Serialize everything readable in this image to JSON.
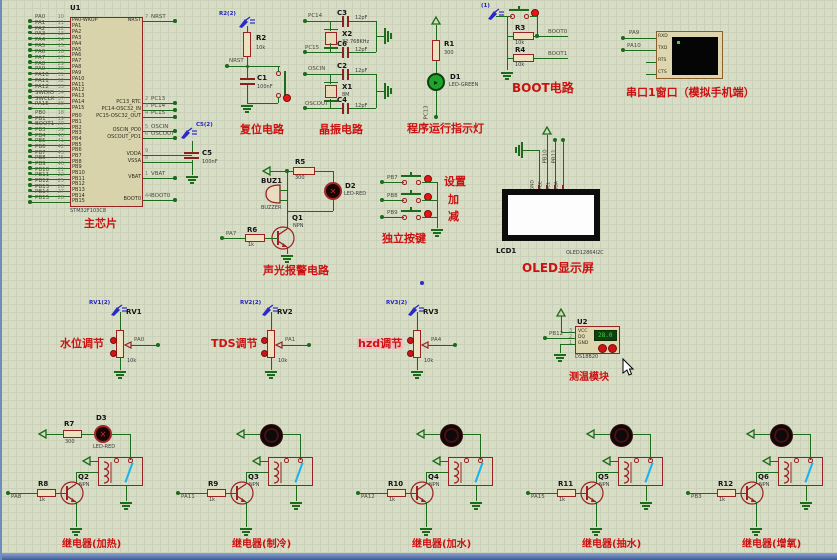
{
  "app": {
    "kind": "proteus-schematic"
  },
  "colors": {
    "wire": "#1b6b1b",
    "component": "#992121",
    "caption_red": "#cc1111",
    "probe_blue": "#2222c0",
    "grid_bg": "#d8ddc6",
    "switch_blue": "#18b2ee"
  },
  "chip": {
    "ref": "U1",
    "part": "STM32F103C8",
    "caption": "主芯片",
    "pins_pa": [
      {
        "net": "PA0",
        "num": "10",
        "name": "PA0-WKUP"
      },
      {
        "net": "PA1",
        "num": "11",
        "name": "PA1"
      },
      {
        "net": "PA2",
        "num": "12",
        "name": "PA2"
      },
      {
        "net": "PA3",
        "num": "13",
        "name": "PA3"
      },
      {
        "net": "PA4",
        "num": "14",
        "name": "PA4"
      },
      {
        "net": "PA5",
        "num": "15",
        "name": "PA5"
      },
      {
        "net": "PA6",
        "num": "16",
        "name": "PA6"
      },
      {
        "net": "PA7",
        "num": "17",
        "name": "PA7"
      },
      {
        "net": "PA8",
        "num": "29",
        "name": "PA8"
      },
      {
        "net": "PA9",
        "num": "30",
        "name": "PA9"
      },
      {
        "net": "PA10",
        "num": "31",
        "name": "PA10"
      },
      {
        "net": "PA11",
        "num": "32",
        "name": "PA11"
      },
      {
        "net": "PA12",
        "num": "33",
        "name": "PA12"
      },
      {
        "net": "SWDIO",
        "num": "34",
        "name": "PA13"
      },
      {
        "net": "SWCLK",
        "num": "37",
        "name": "PA14"
      },
      {
        "net": "PA15",
        "num": "38",
        "name": "PA15"
      }
    ],
    "pins_pb": [
      {
        "net": "PB0",
        "num": "18",
        "name": "PB0"
      },
      {
        "net": "PB1",
        "num": "19",
        "name": "PB1"
      },
      {
        "net": "BOOT1",
        "num": "20",
        "name": "PB2"
      },
      {
        "net": "PB3",
        "num": "39",
        "name": "PB3"
      },
      {
        "net": "PB4",
        "num": "40",
        "name": "PB4"
      },
      {
        "net": "PB5",
        "num": "41",
        "name": "PB5"
      },
      {
        "net": "PB6",
        "num": "42",
        "name": "PB6"
      },
      {
        "net": "PB7",
        "num": "43",
        "name": "PB7"
      },
      {
        "net": "PB8",
        "num": "45",
        "name": "PB8"
      },
      {
        "net": "PB9",
        "num": "46",
        "name": "PB9"
      },
      {
        "net": "PB10",
        "num": "21",
        "name": "PB10"
      },
      {
        "net": "PB11",
        "num": "22",
        "name": "PB11"
      },
      {
        "net": "PB12",
        "num": "25",
        "name": "PB12"
      },
      {
        "net": "PB13",
        "num": "26",
        "name": "PB13"
      },
      {
        "net": "PB14",
        "num": "27",
        "name": "PB14"
      },
      {
        "net": "PB15",
        "num": "28",
        "name": "PB15"
      }
    ],
    "pins_right": [
      {
        "name": "NRST",
        "num": "7",
        "net": "NRST"
      },
      {
        "name": "PC13_RTC",
        "num": "2",
        "net": "PC13"
      },
      {
        "name": "PC14-OSC32_IN",
        "num": "3",
        "net": "PC14"
      },
      {
        "name": "PC15-OSC32_OUT",
        "num": "4",
        "net": "PC15"
      },
      {
        "name": "OSCIN_PD0",
        "num": "5",
        "net": "OSCIN"
      },
      {
        "name": "OSCOUT_PD1",
        "num": "6",
        "net": "OSCOUT"
      },
      {
        "name": "VDDA",
        "num": "9",
        "net": ""
      },
      {
        "name": "VSSA",
        "num": "8",
        "net": ""
      },
      {
        "name": "VBAT",
        "num": "1",
        "net": "VBAT"
      },
      {
        "name": "BOOT0",
        "num": "44",
        "net": "BOOT0"
      }
    ]
  },
  "c5": {
    "probe": "C5(2)",
    "ref": "C5",
    "val": "100nF"
  },
  "reset": {
    "probe": "R2(2)",
    "r_ref": "R2",
    "r_val": "10k",
    "net": "NRST",
    "c_ref": "C1",
    "c_val": "100nF",
    "caption": "复位电路"
  },
  "crystal": {
    "caption": "晶振电路",
    "groups": [
      {
        "net_top": "PC14",
        "cap_top_ref": "C3",
        "cap_top_val": "12pF",
        "xtal_ref": "X2",
        "xtal_val": "32.768KHz",
        "net_bot": "PC15",
        "cap_bot_ref": "C6",
        "cap_bot_val": "12pF"
      },
      {
        "net_top": "OSCIN",
        "cap_top_ref": "C2",
        "cap_top_val": "12pF",
        "xtal_ref": "X1",
        "xtal_val": "8M",
        "net_bot": "OSCOUT",
        "cap_bot_ref": "C4",
        "cap_bot_val": "12pF"
      }
    ]
  },
  "run_led": {
    "r_ref": "R1",
    "r_val": "300",
    "d_ref": "D1",
    "d_val": "LED-GREEN",
    "net": "PC13",
    "caption": "程序运行指示灯"
  },
  "boot": {
    "probe": "(1)",
    "r1_ref": "R3",
    "r1_val": "10k",
    "net1": "BOOT0",
    "r2_ref": "R4",
    "r2_val": "10k",
    "net2": "BOOT1",
    "caption": "BOOT电路"
  },
  "serial": {
    "caption": "串口1窗口（模拟手机端）",
    "nets": [
      "PA9",
      "PA10"
    ],
    "pins": [
      "RXD",
      "TXD",
      "RTS",
      "CTS"
    ]
  },
  "alarm": {
    "caption": "声光报警电路",
    "r5_ref": "R5",
    "r5_val": "300",
    "buz_ref": "BUZ1",
    "buz_val": "BUZZER",
    "d2_ref": "D2",
    "d2_val": "LED-RED",
    "q_ref": "Q1",
    "q_val": "NPN",
    "r6_ref": "R6",
    "r6_val": "1k",
    "net": "PA7"
  },
  "keys": {
    "caption": "独立按键",
    "rows": [
      {
        "net": "PB7",
        "label": "设置"
      },
      {
        "net": "PB8",
        "label": "加"
      },
      {
        "net": "PB9",
        "label": "减"
      }
    ]
  },
  "oled": {
    "caption": "OLED显示屏",
    "ref": "LCD1",
    "part": "OLED12864I2C",
    "pins": [
      "GND",
      "VCC",
      "SCL",
      "SDA"
    ],
    "nets": [
      "PB10",
      "PB11"
    ]
  },
  "pots": [
    {
      "probe": "RV1(2)",
      "ref": "RV1",
      "val": "10k",
      "net": "PA0",
      "caption": "水位调节",
      "highlight": false
    },
    {
      "probe": "RV2(2)",
      "ref": "RV2",
      "val": "10k",
      "net": "PA1",
      "caption": "TDS调节",
      "highlight": false
    },
    {
      "probe": "RV3(2)",
      "ref": "RV3",
      "val": "10k",
      "net": "PA4",
      "caption": "hzd调节",
      "highlight": true
    }
  ],
  "temp": {
    "caption": "测温模块",
    "ref": "U2",
    "part": "DS18B20",
    "pins": [
      {
        "num": "3",
        "name": "VCC"
      },
      {
        "num": "2",
        "name": "DQ"
      },
      {
        "num": "1",
        "name": "GND"
      }
    ],
    "net": "PB12",
    "display": "28.0"
  },
  "relays": [
    {
      "caption": "继电器(加热)",
      "net": "PA8",
      "r_ref": "R8",
      "r_val": "1k",
      "q_ref": "Q2",
      "q_val": "NPN",
      "top": "led",
      "t_r_ref": "R7",
      "t_r_val": "300",
      "t_d_ref": "D3",
      "t_d_val": "LED-RED"
    },
    {
      "caption": "继电器(制冷)",
      "net": "PA11",
      "r_ref": "R9",
      "r_val": "1k",
      "q_ref": "Q3",
      "q_val": "NPN",
      "top": "motor"
    },
    {
      "caption": "继电器(加水)",
      "net": "PA12",
      "r_ref": "R10",
      "r_val": "1k",
      "q_ref": "Q4",
      "q_val": "NPN",
      "top": "motor"
    },
    {
      "caption": "继电器(抽水)",
      "net": "PA15",
      "r_ref": "R11",
      "r_val": "1k",
      "q_ref": "Q5",
      "q_val": "NPN",
      "top": "motor"
    },
    {
      "caption": "继电器(增氧)",
      "net": "PB3",
      "r_ref": "R12",
      "r_val": "1k",
      "q_ref": "Q6",
      "q_val": "NPN",
      "top": "motor"
    }
  ]
}
